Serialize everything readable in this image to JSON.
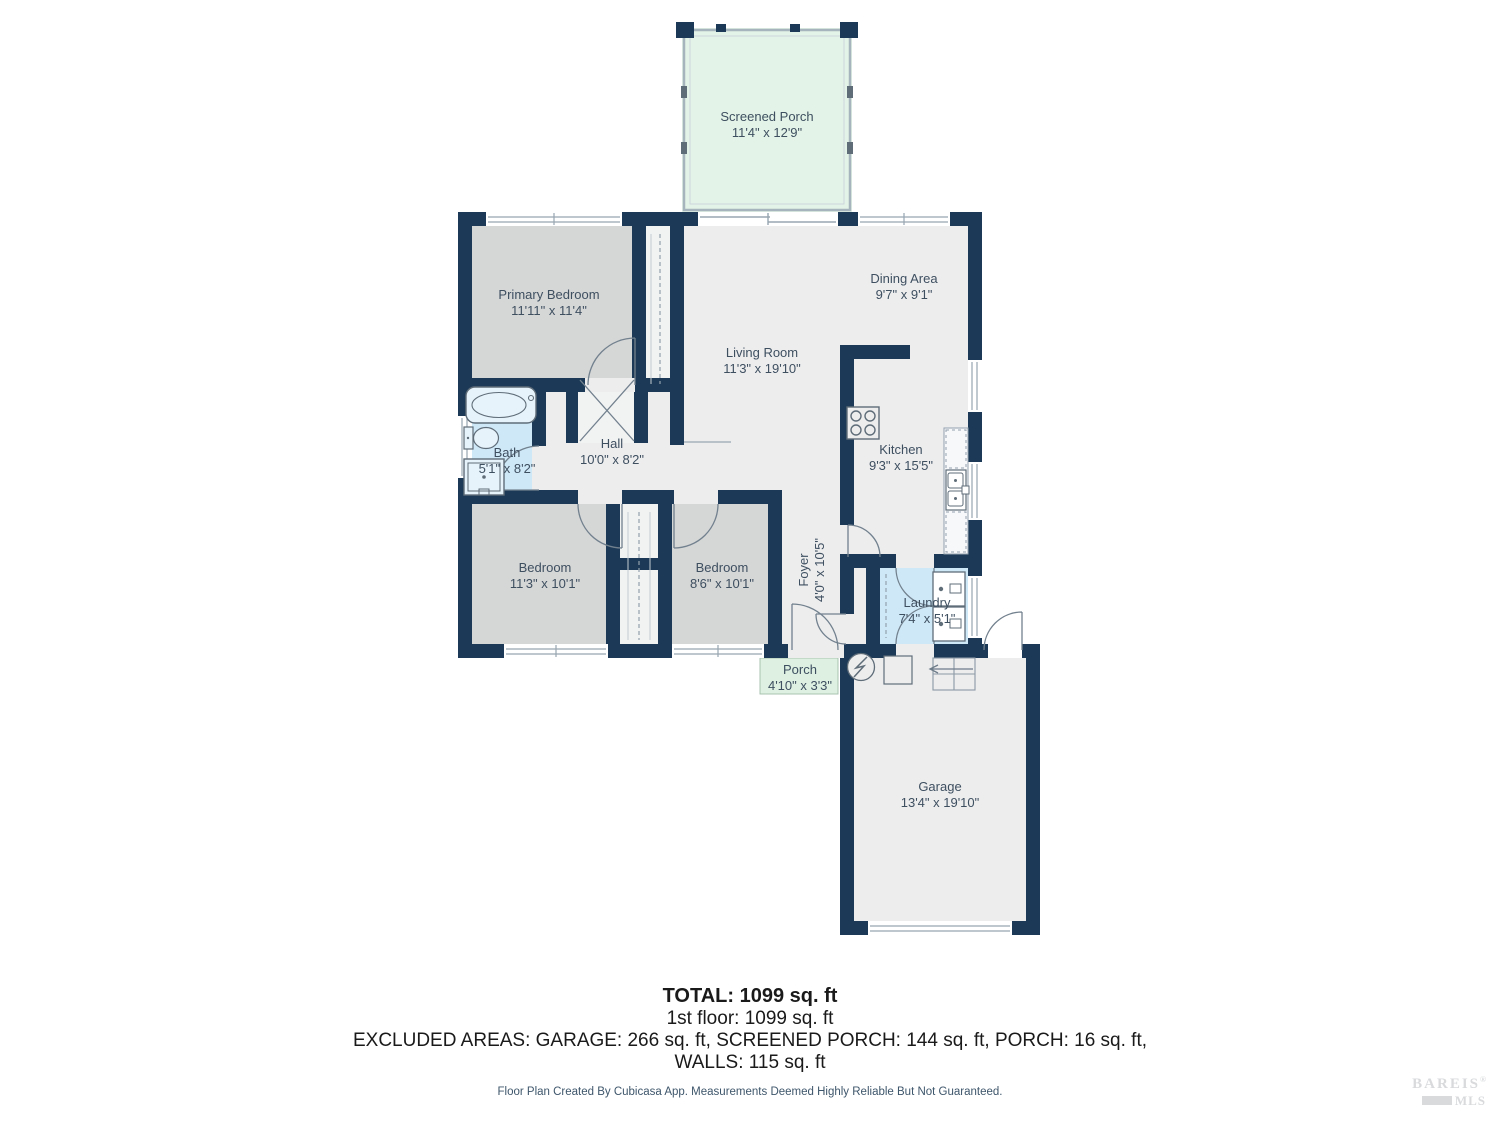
{
  "rooms": [
    {
      "name": "Screened Porch",
      "dims": "11'4\" x 12'9\""
    },
    {
      "name": "Primary Bedroom",
      "dims": "11'11\" x 11'4\""
    },
    {
      "name": "Dining Area",
      "dims": "9'7\" x 9'1\""
    },
    {
      "name": "Living Room",
      "dims": "11'3\" x 19'10\""
    },
    {
      "name": "Bath",
      "dims": "5'1\" x 8'2\""
    },
    {
      "name": "Hall",
      "dims": "10'0\" x 8'2\""
    },
    {
      "name": "Kitchen",
      "dims": "9'3\" x 15'5\""
    },
    {
      "name": "Bedroom",
      "dims": "11'3\" x 10'1\""
    },
    {
      "name": "Bedroom",
      "dims": "8'6\" x 10'1\""
    },
    {
      "name": "Foyer",
      "dims": "4'0\" x 10'5\""
    },
    {
      "name": "Laundry",
      "dims": "7'4\" x 5'1\""
    },
    {
      "name": "Porch",
      "dims": "4'10\" x 3'3\""
    },
    {
      "name": "Garage",
      "dims": "13'4\" x 19'10\""
    }
  ],
  "summary": {
    "total": "TOTAL: 1099 sq. ft",
    "first_floor": "1st floor: 1099 sq. ft",
    "excluded": "EXCLUDED AREAS: GARAGE: 266 sq. ft, SCREENED PORCH: 144 sq. ft, PORCH: 16 sq. ft,",
    "walls": "WALLS: 115 sq. ft"
  },
  "disclaimer": "Floor Plan Created By Cubicasa App. Measurements Deemed Highly Reliable But Not Guaranteed.",
  "logo": {
    "name": "BAREIS",
    "registered": "®",
    "suffix": "MLS"
  },
  "colors": {
    "wall": "#1c3a57",
    "room": "#ededee",
    "bedroom": "#d5d6d6",
    "wet_room": "#cfe8f7",
    "screened_porch": "#e3f3e7",
    "porch": "#ddf0e2",
    "label_text": "#3e4f60"
  }
}
